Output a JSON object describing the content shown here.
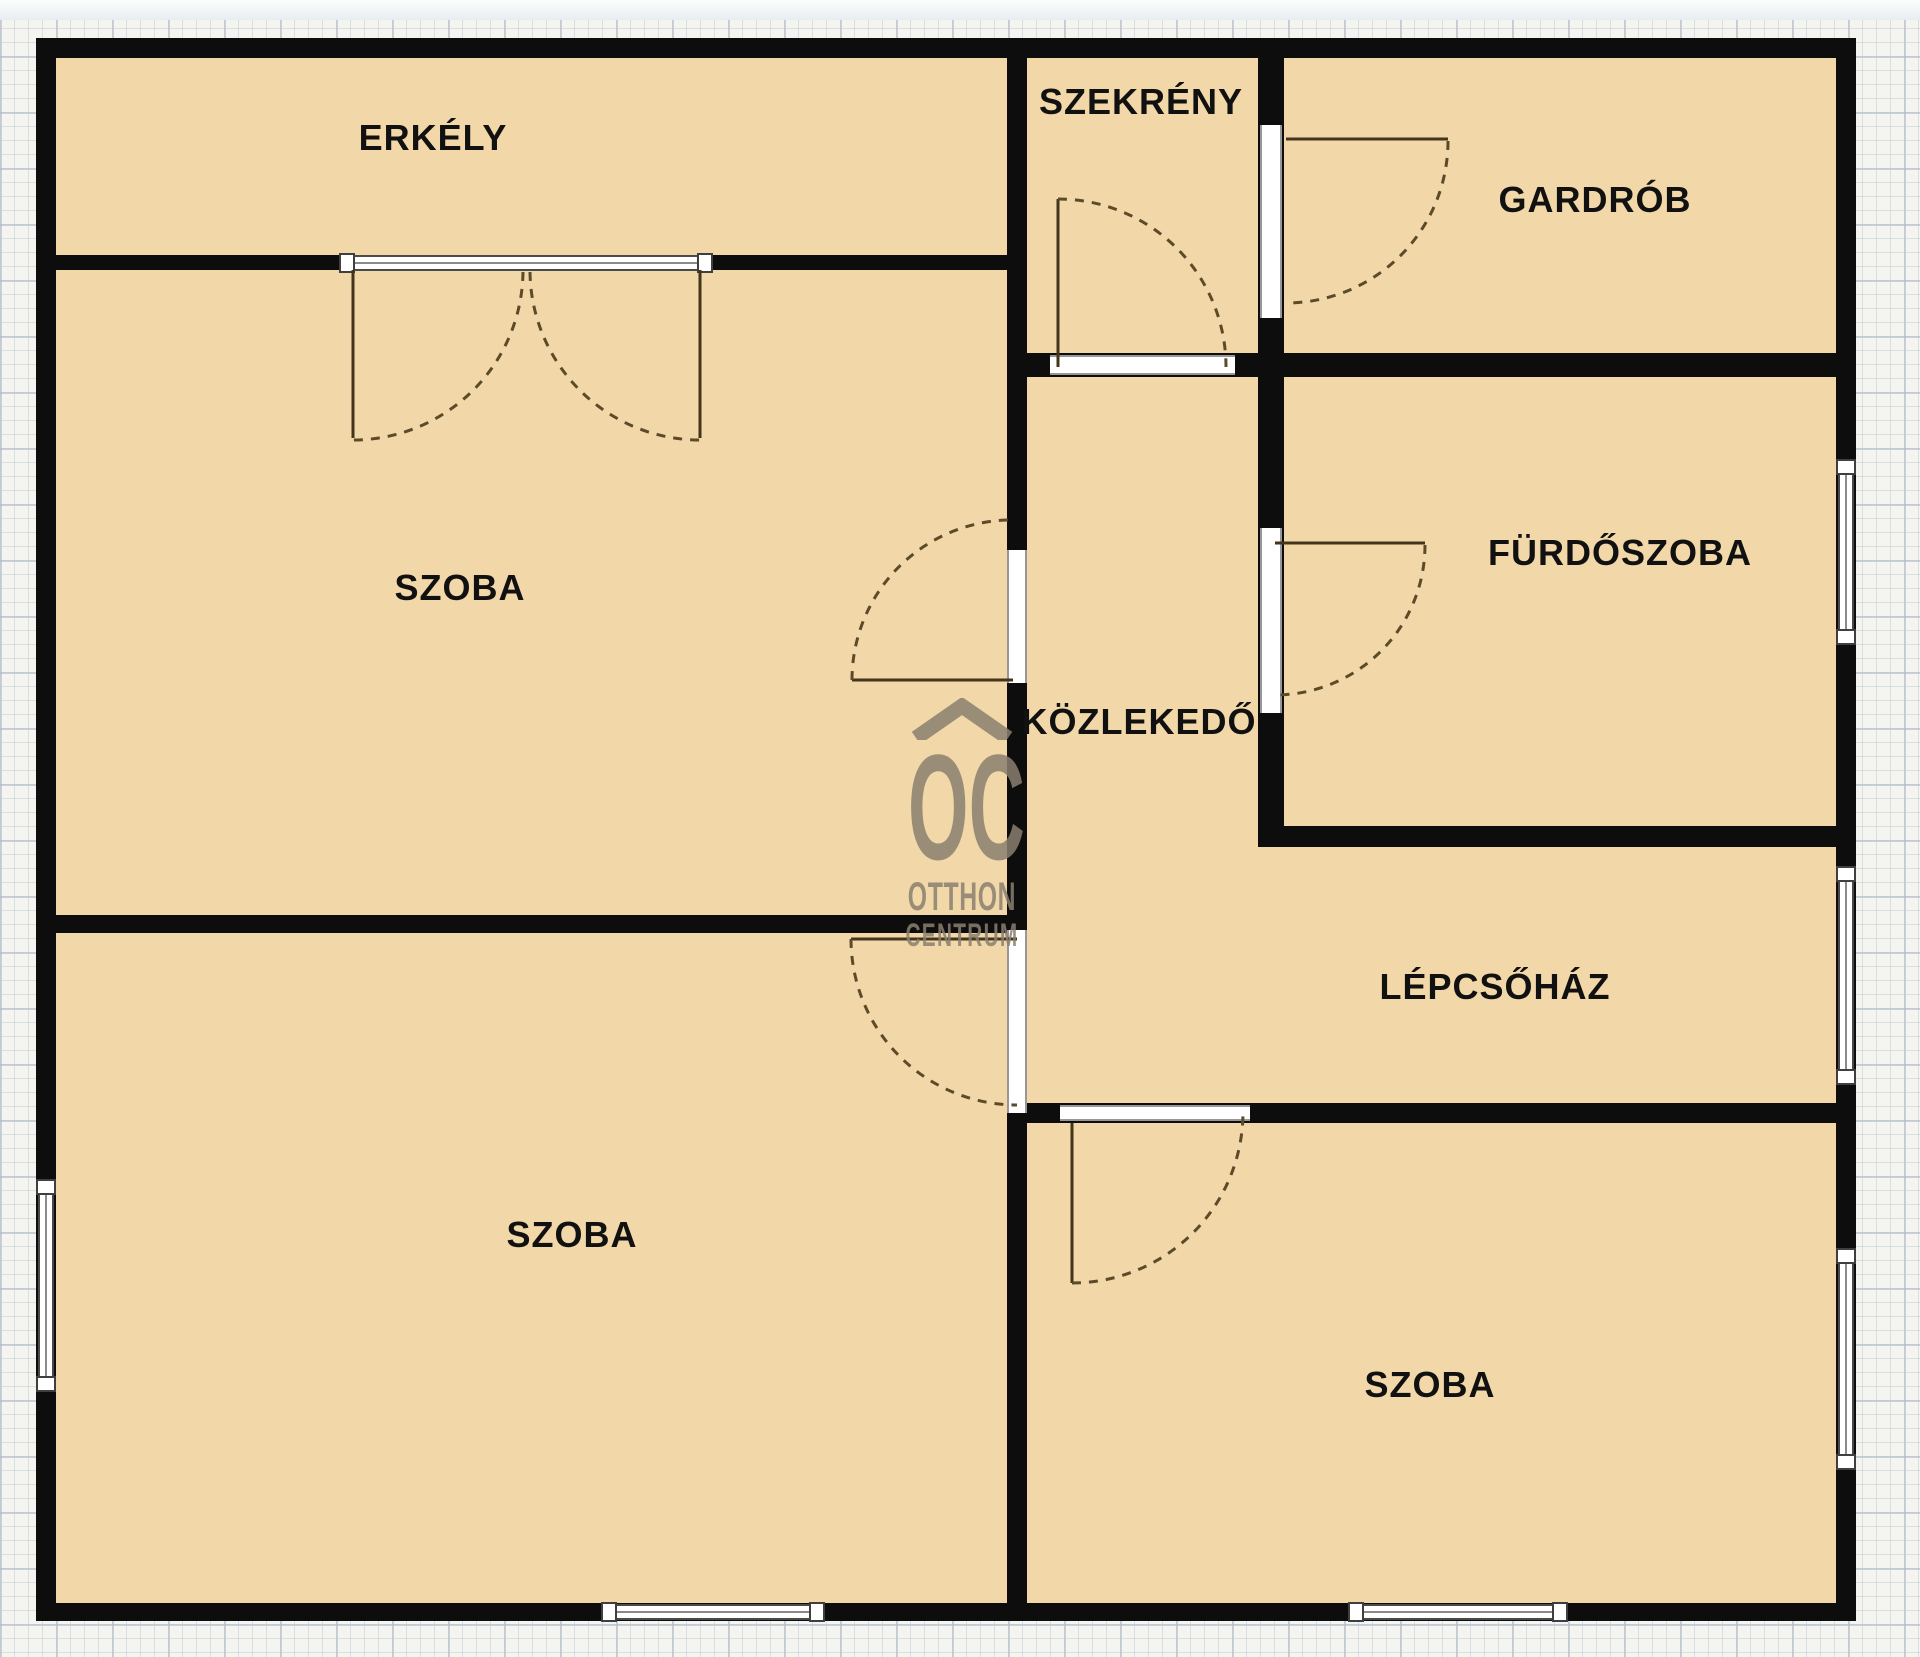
{
  "rooms": {
    "erkely": {
      "label": "ERKÉLY"
    },
    "szekreny": {
      "label": "SZEKRÉNY"
    },
    "gardrob": {
      "label": "GARDRÓB"
    },
    "szoba_top_left": {
      "label": "SZOBA"
    },
    "furdoszoba": {
      "label": "FÜRDŐSZOBA"
    },
    "kozlekedo": {
      "label": "KÖZLEKEDŐ"
    },
    "lepcsohaz": {
      "label": "LÉPCSŐHÁZ"
    },
    "szoba_bottom_left": {
      "label": "SZOBA"
    },
    "szoba_bottom_right": {
      "label": "SZOBA"
    }
  },
  "watermark": {
    "initials": "OC",
    "line1": "OTTHON",
    "line2": "CENTRUM"
  },
  "colors": {
    "floor": "#f2d8a8",
    "wall": "#0d0d0d",
    "label": "#111111",
    "watermark": "#8a8070",
    "paper": "#f4f4f1",
    "door_arc": "#5c4b28",
    "door_leaf": "#42351b",
    "window_frame": "#4a4a4a"
  }
}
